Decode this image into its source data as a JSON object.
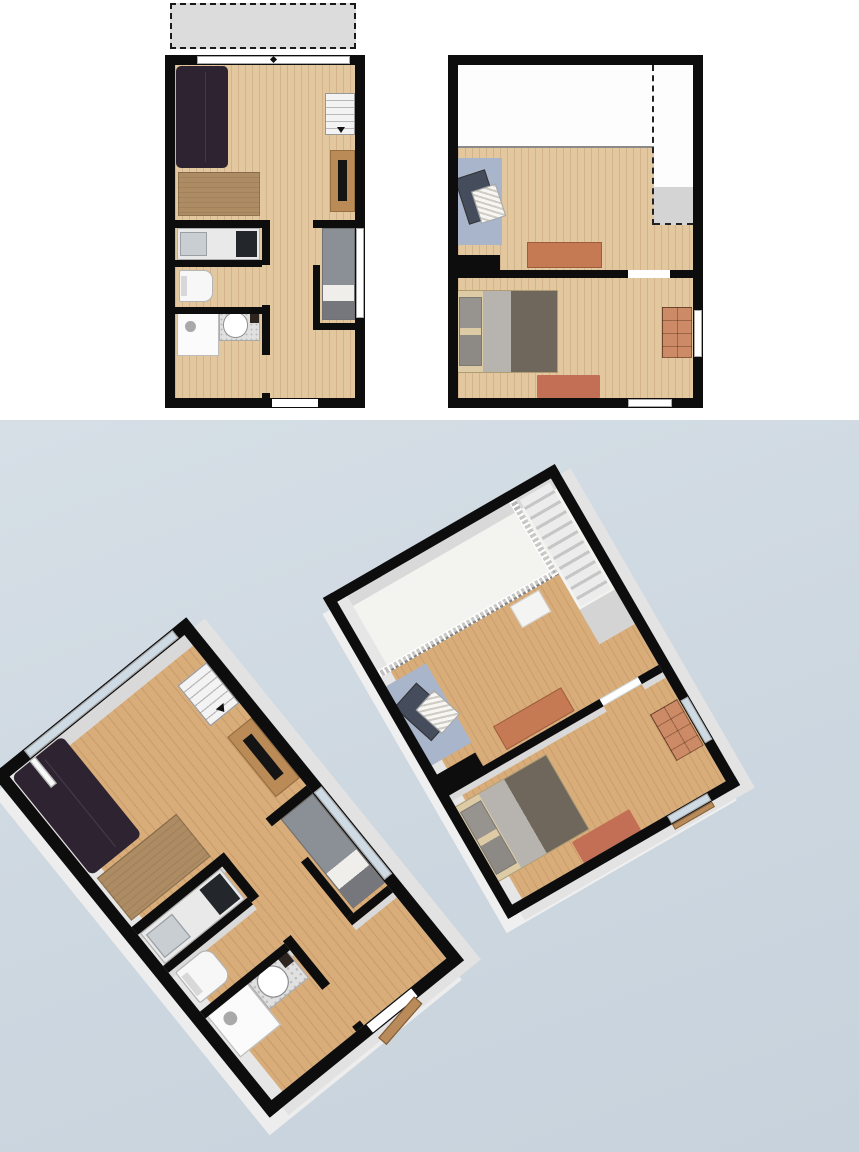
{
  "canvas": {
    "width": 859,
    "height": 1152,
    "top_background": "#ffffff",
    "bottom_background": "linear-gradient(160deg,#d6dfe6 0%,#cdd7e0 55%,#c7d2dc 100%)",
    "split_y": 420,
    "bottom_height": 732
  },
  "palette": {
    "wall": "#0d0d0d",
    "wood_floor": "#e3c79f",
    "wood_floor_3d": "#d9ad79",
    "terrace": "#dcdcdc",
    "landing_gray": "#d4d4d4",
    "sofa": "#2d2331",
    "console_wood": "#ad8c64",
    "tv_stand_wood": "#bb8b57",
    "bed_single_duvet": "#8b8f96",
    "bed_double_duvet": "#6f675c",
    "bed_frame": "#ddcba6",
    "terracotta": "#c57a54",
    "dresser": "#cc8a66",
    "bedroom_rug": "#c36f56",
    "blue_rug": "#a9b5ca",
    "crib_base": "#454d5c",
    "glass_3d": "#cfdbe4",
    "background_blue": "#cdd7e0"
  },
  "floors": [
    {
      "id": "ground-floor",
      "size": {
        "w": 200,
        "h": 353
      },
      "wall": 10,
      "views": {
        "plan2d": {
          "left": 165,
          "top": 55
        },
        "view3d": {
          "left": 128,
          "top": 691,
          "rotate": -39,
          "scale": 1.25,
          "wall_faces": "12px 9px 0 -1px #e2e2e2, -10px 12px 0 -1px #ededed"
        }
      },
      "items": [
        {
          "name": "floor-living-area",
          "cls": "floor-wood",
          "x": 10,
          "y": 10,
          "w": 180,
          "h": 333,
          "interactable": false
        },
        {
          "name": "terrace",
          "cls": "terrace",
          "x": 5,
          "y": -52,
          "w": 186,
          "h": 46,
          "only2d": true,
          "interactable": true
        },
        {
          "name": "wall-face-north",
          "cls": "face",
          "x": 10,
          "y": 10,
          "w": 180,
          "h": 11,
          "only3d": true,
          "interactable": false
        },
        {
          "name": "wall-face-west",
          "cls": "face-light",
          "x": 10,
          "y": 10,
          "w": 11,
          "h": 333,
          "only3d": true,
          "interactable": false
        },
        {
          "name": "wall-face-kitchen",
          "cls": "face",
          "x": 10,
          "y": 173,
          "w": 87,
          "h": 5,
          "only3d": true,
          "interactable": false
        },
        {
          "name": "wall-face-wc",
          "cls": "face",
          "x": 10,
          "y": 212,
          "w": 87,
          "h": 5,
          "only3d": true,
          "interactable": false
        },
        {
          "name": "wall-face-bath",
          "cls": "face",
          "x": 10,
          "y": 259,
          "w": 87,
          "h": 5,
          "only3d": true,
          "interactable": false
        },
        {
          "name": "wall-face-bedroom",
          "cls": "face",
          "x": 148,
          "y": 275,
          "w": 42,
          "h": 5,
          "only3d": true,
          "interactable": false
        },
        {
          "name": "sofa",
          "cls": "sofa",
          "x": 11,
          "y": 11,
          "w": 52,
          "h": 102,
          "interactable": true
        },
        {
          "name": "sideboard-console",
          "cls": "console",
          "x": 13,
          "y": 117,
          "w": 82,
          "h": 44,
          "interactable": true
        },
        {
          "name": "staircase",
          "cls": "stairs2d",
          "x": 160,
          "y": 38,
          "w": 30,
          "h": 42,
          "interactable": true
        },
        {
          "name": "tv-stand",
          "cls": "tvstand",
          "x": 165,
          "y": 95,
          "w": 25,
          "h": 62,
          "interactable": true
        },
        {
          "name": "kitchen-counter",
          "cls": "counter",
          "x": 12,
          "y": 173,
          "w": 83,
          "h": 32,
          "interactable": true
        },
        {
          "name": "toilet",
          "cls": "toilet",
          "x": 14,
          "y": 215,
          "w": 34,
          "h": 32,
          "interactable": true
        },
        {
          "name": "shower",
          "cls": "shower",
          "x": 12,
          "y": 257,
          "w": 42,
          "h": 44,
          "interactable": true
        },
        {
          "name": "washbasin",
          "cls": "basin",
          "x": 54,
          "y": 252,
          "w": 41,
          "h": 34,
          "interactable": true
        },
        {
          "name": "single-bed",
          "cls": "bed-single",
          "x": 157,
          "y": 173,
          "w": 33,
          "h": 92,
          "interactable": true
        },
        {
          "name": "wall-north",
          "cls": "wall",
          "x": 0,
          "y": 0,
          "w": 200,
          "h": 10,
          "interactable": false
        },
        {
          "name": "wall-south",
          "cls": "wall",
          "x": 0,
          "y": 343,
          "w": 200,
          "h": 10,
          "interactable": false
        },
        {
          "name": "wall-west",
          "cls": "wall",
          "x": 0,
          "y": 0,
          "w": 10,
          "h": 353,
          "interactable": false
        },
        {
          "name": "wall-east",
          "cls": "wall",
          "x": 190,
          "y": 0,
          "w": 10,
          "h": 353,
          "interactable": false
        },
        {
          "name": "wall-kitchen-top",
          "cls": "wall",
          "x": 10,
          "y": 165,
          "w": 95,
          "h": 8,
          "interactable": false
        },
        {
          "name": "wall-bedroom-top",
          "cls": "wall",
          "x": 148,
          "y": 165,
          "w": 42,
          "h": 8,
          "interactable": false
        },
        {
          "name": "wall-corridor-1",
          "cls": "wall",
          "x": 97,
          "y": 165,
          "w": 8,
          "h": 45,
          "interactable": false
        },
        {
          "name": "wall-corridor-2",
          "cls": "wall",
          "x": 97,
          "y": 250,
          "w": 8,
          "h": 50,
          "interactable": false
        },
        {
          "name": "wall-corridor-3",
          "cls": "wall",
          "x": 97,
          "y": 338,
          "w": 8,
          "h": 5,
          "interactable": false
        },
        {
          "name": "wall-kitchen-wc",
          "cls": "wall",
          "x": 10,
          "y": 205,
          "w": 87,
          "h": 7,
          "interactable": false
        },
        {
          "name": "wall-wc-bath",
          "cls": "wall",
          "x": 10,
          "y": 252,
          "w": 87,
          "h": 7,
          "interactable": false
        },
        {
          "name": "wall-bedroom-west",
          "cls": "wall",
          "x": 148,
          "y": 210,
          "w": 7,
          "h": 58,
          "interactable": false
        },
        {
          "name": "wall-bedroom-bottom",
          "cls": "wall",
          "x": 148,
          "y": 268,
          "w": 42,
          "h": 7,
          "interactable": false
        },
        {
          "name": "window-north",
          "cls": "win",
          "x": 32,
          "y": 1,
          "w": 153,
          "h": 8,
          "interactable": true
        },
        {
          "name": "window-north-marker",
          "cls": "win-marker",
          "x": 106,
          "y": 2,
          "w": 5,
          "h": 5,
          "only2d": true,
          "interactable": false
        },
        {
          "name": "window-east-bedroom",
          "cls": "win",
          "x": 191,
          "y": 173,
          "w": 8,
          "h": 90,
          "interactable": true
        },
        {
          "name": "entry-door",
          "cls": "door-gap",
          "x": 107,
          "y": 344,
          "w": 46,
          "h": 8,
          "interactable": true
        },
        {
          "name": "terrace-door-leaf",
          "cls": "door-white",
          "x": 30,
          "y": 10,
          "w": 6,
          "h": 28,
          "only3d": true,
          "interactable": true
        },
        {
          "name": "entry-door-leaf",
          "cls": "doorleaf",
          "x": 108,
          "y": 354,
          "w": 44,
          "h": 9,
          "rot": -10,
          "only3d": true,
          "interactable": true
        }
      ]
    },
    {
      "id": "upper-floor",
      "size": {
        "w": 255,
        "h": 353
      },
      "wall": 10,
      "views": {
        "plan2d": {
          "left": 448,
          "top": 55
        },
        "view3d": {
          "left": 404,
          "top": 515,
          "rotate": -30,
          "scale": 1.05,
          "wall_faces": "12px 10px 0 -1px #e3e3e3, -9px 12px 0 -1px #efefef"
        }
      },
      "items": [
        {
          "name": "floor-void-open-below",
          "cls": "floor-white",
          "x": 10,
          "y": 10,
          "w": 196,
          "h": 83,
          "interactable": false
        },
        {
          "name": "floor-stairwell",
          "cls": "floor-white",
          "x": 206,
          "y": 10,
          "w": 39,
          "h": 122,
          "interactable": false
        },
        {
          "name": "stair-landing",
          "cls": "floor-gray",
          "x": 206,
          "y": 132,
          "w": 39,
          "h": 38,
          "interactable": false
        },
        {
          "name": "floor-landing-room",
          "cls": "floor-wood",
          "x": 10,
          "y": 93,
          "w": 196,
          "h": 122,
          "interactable": false
        },
        {
          "name": "floor-stair-strip",
          "cls": "floor-wood",
          "x": 206,
          "y": 170,
          "w": 39,
          "h": 45,
          "interactable": false
        },
        {
          "name": "floor-bedroom",
          "cls": "floor-wood",
          "x": 10,
          "y": 223,
          "w": 235,
          "h": 120,
          "interactable": false
        },
        {
          "name": "void-edge-line",
          "cls": "edge",
          "x": 10,
          "y": 91,
          "w": 196,
          "h": 2,
          "interactable": false
        },
        {
          "name": "stairwell-dash-vertical",
          "cls": "dash-v",
          "x": 204,
          "y": 10,
          "w": 2,
          "h": 160,
          "only2d": true,
          "interactable": false
        },
        {
          "name": "stairwell-dash-horizontal",
          "cls": "dash-h",
          "x": 206,
          "y": 168,
          "w": 39,
          "h": 2,
          "only2d": true,
          "interactable": false
        },
        {
          "name": "wall-face-north",
          "cls": "face",
          "x": 10,
          "y": 10,
          "w": 235,
          "h": 11,
          "only3d": true,
          "interactable": false
        },
        {
          "name": "wall-face-west",
          "cls": "face-light",
          "x": 10,
          "y": 10,
          "w": 11,
          "h": 333,
          "only3d": true,
          "interactable": false
        },
        {
          "name": "wall-face-divider-1",
          "cls": "face",
          "x": 10,
          "y": 223,
          "w": 170,
          "h": 6,
          "only3d": true,
          "interactable": false
        },
        {
          "name": "wall-face-divider-2",
          "cls": "face",
          "x": 222,
          "y": 223,
          "w": 23,
          "h": 6,
          "only3d": true,
          "interactable": false
        },
        {
          "name": "stairs-going-down",
          "cls": "stairs3d",
          "x": 209,
          "y": 13,
          "w": 33,
          "h": 117,
          "only3d": true,
          "interactable": false
        },
        {
          "name": "void-railing-long",
          "cls": "railing-h",
          "x": 10,
          "y": 87,
          "w": 194,
          "h": 6,
          "only3d": true,
          "interactable": true
        },
        {
          "name": "void-railing-short",
          "cls": "railing-v",
          "x": 200,
          "y": 10,
          "w": 6,
          "h": 83,
          "only3d": true,
          "interactable": true
        },
        {
          "name": "side-table",
          "cls": "table-white",
          "x": 150,
          "y": 96,
          "w": 32,
          "h": 24,
          "only3d": true,
          "interactable": true
        },
        {
          "name": "blue-rug",
          "cls": "bluerug",
          "x": 7,
          "y": 103,
          "w": 47,
          "h": 87,
          "interactable": true
        },
        {
          "name": "crib",
          "cls": "crib",
          "x": 13,
          "y": 118,
          "w": 32,
          "h": 48,
          "rot": -18,
          "interactable": true
        },
        {
          "name": "desk",
          "cls": "desk",
          "x": 79,
          "y": 187,
          "w": 75,
          "h": 26,
          "interactable": true
        },
        {
          "name": "double-bed",
          "cls": "bed-double",
          "x": 7,
          "y": 235,
          "w": 103,
          "h": 83,
          "interactable": true
        },
        {
          "name": "dresser",
          "cls": "dresser",
          "x": 214,
          "y": 252,
          "w": 30,
          "h": 51,
          "interactable": true
        },
        {
          "name": "bedroom-rug",
          "cls": "rug",
          "x": 89,
          "y": 320,
          "w": 63,
          "h": 23,
          "color": "#c36f56",
          "interactable": true
        },
        {
          "name": "wall-north",
          "cls": "wall",
          "x": 0,
          "y": 0,
          "w": 255,
          "h": 10,
          "interactable": false
        },
        {
          "name": "wall-south",
          "cls": "wall",
          "x": 0,
          "y": 343,
          "w": 255,
          "h": 10,
          "interactable": false
        },
        {
          "name": "wall-west",
          "cls": "wall",
          "x": 0,
          "y": 0,
          "w": 10,
          "h": 353,
          "interactable": false
        },
        {
          "name": "wall-east",
          "cls": "wall",
          "x": 245,
          "y": 0,
          "w": 10,
          "h": 353,
          "interactable": false
        },
        {
          "name": "wall-room-divider-1",
          "cls": "wall",
          "x": 10,
          "y": 215,
          "w": 170,
          "h": 8,
          "interactable": false
        },
        {
          "name": "wall-room-divider-2",
          "cls": "wall",
          "x": 222,
          "y": 215,
          "w": 23,
          "h": 8,
          "interactable": false
        },
        {
          "name": "wall-chunk-west",
          "cls": "wall",
          "x": 2,
          "y": 200,
          "w": 50,
          "h": 23,
          "interactable": false
        },
        {
          "name": "bedroom-door",
          "cls": "door-gap",
          "x": 180,
          "y": 216,
          "w": 42,
          "h": 6,
          "interactable": true
        },
        {
          "name": "window-east-bedroom",
          "cls": "win",
          "x": 246,
          "y": 255,
          "w": 8,
          "h": 47,
          "interactable": true
        },
        {
          "name": "window-south-bedroom",
          "cls": "win",
          "x": 180,
          "y": 344,
          "w": 44,
          "h": 8,
          "interactable": true
        },
        {
          "name": "window-sill-3d",
          "cls": "doorleaf",
          "x": 180,
          "y": 353,
          "w": 44,
          "h": 6,
          "only3d": true,
          "interactable": false
        }
      ]
    }
  ]
}
